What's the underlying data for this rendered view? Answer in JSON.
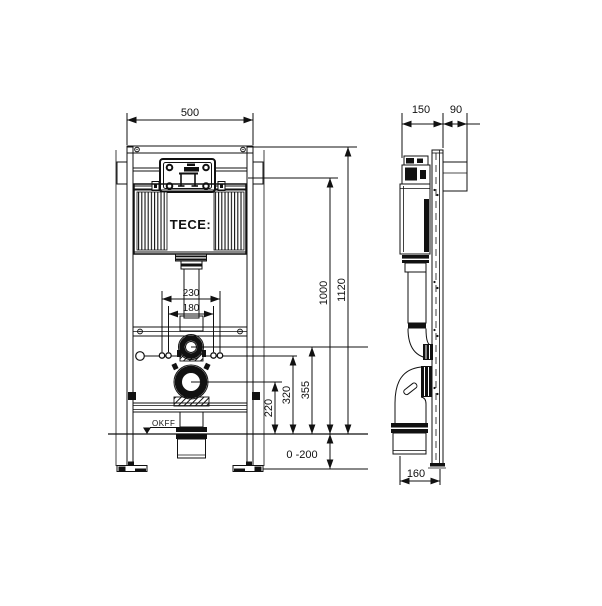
{
  "drawing": {
    "brand_label": "TECE:",
    "floor_label": "OKFF",
    "line_color": "#111111",
    "background_color": "#ffffff",
    "dims": {
      "frame_width": "500",
      "bolt_spacing_outer": "230",
      "bolt_spacing_inner": "180",
      "actuator_height": "1000",
      "frame_height": "1120",
      "flush_bend_height": "355",
      "supply_height": "320",
      "drain_height": "220",
      "foot_adjust_range": "0 -200",
      "frame_depth": "150",
      "wall_depth": "90",
      "drain_offset": "160"
    }
  }
}
